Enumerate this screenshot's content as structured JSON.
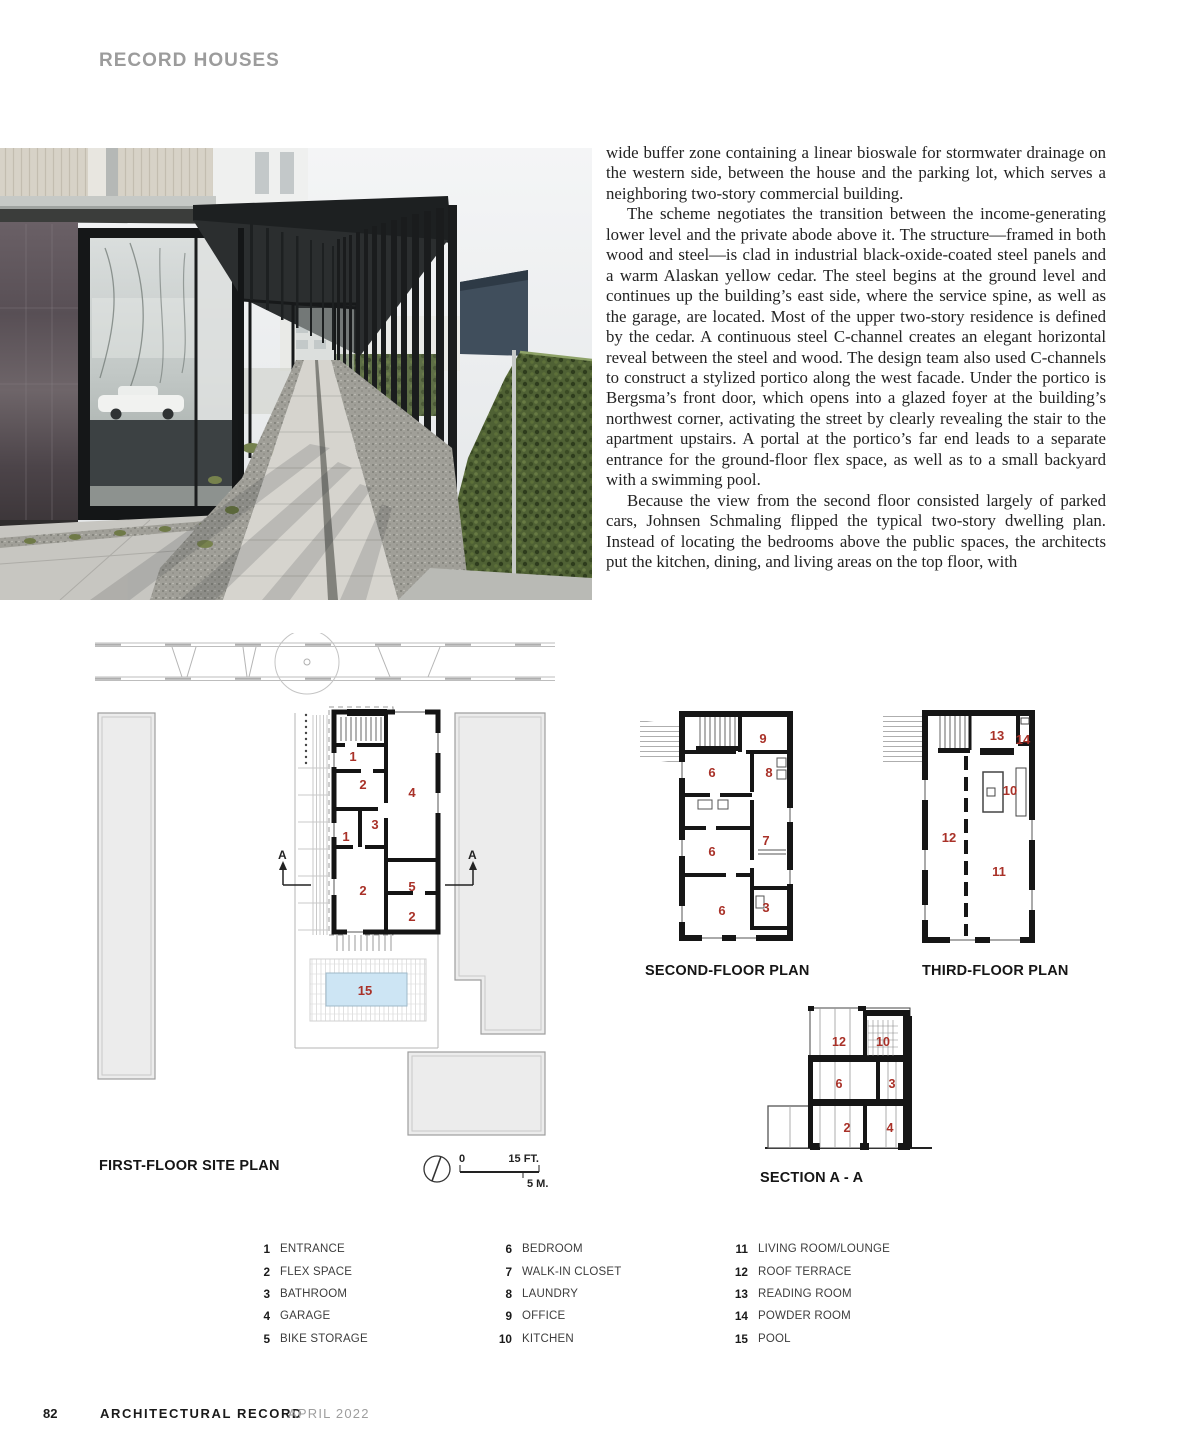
{
  "header": {
    "section_title": "RECORD HOUSES"
  },
  "article": {
    "paragraphs": [
      "wide buffer zone containing a linear bioswale for stormwater drainage on the western side, between the house and the parking lot, which serves a neighboring two-story commercial building.",
      "The scheme negotiates the transition between the income-generating lower level and the private abode above it. The structure—framed in both wood and steel—is clad in industrial black-oxide-coated steel panels and a warm Alaskan yellow cedar. The steel begins at the ground level and continues up the building’s east side, where the service spine, as well as the garage, are located. Most of the upper two-story residence is defined by the cedar. A continuous steel C-channel creates an elegant horizontal reveal between the steel and wood. The design team also used C-channels to construct a stylized portico along the west facade. Under the portico is Bergsma’s front door, which opens into a glazed foyer at the building’s northwest corner, activating the street by clearly revealing the stair to the apartment upstairs. A portal at the portico’s far end leads to a separate entrance for the ground-floor flex space, as well as to a small backyard with a swimming pool.",
      "Because the view from the second floor consisted largely of parked cars, Johnsen Schmaling flipped the typical two-story dwelling plan. Instead of locating the bedrooms above the public spaces, the architects put the kitchen, dining, and living areas on the top floor, with"
    ]
  },
  "plans": {
    "site": {
      "title": "FIRST-FLOOR SITE PLAN",
      "labels": [
        "1",
        "2",
        "4",
        "3",
        "1",
        "2",
        "5",
        "2",
        "15"
      ],
      "section_letter": "A"
    },
    "second": {
      "title": "SECOND-FLOOR PLAN",
      "labels": [
        "9",
        "6",
        "8",
        "6",
        "7",
        "6",
        "3"
      ]
    },
    "third": {
      "title": "THIRD-FLOOR PLAN",
      "labels": [
        "13",
        "14",
        "10",
        "12",
        "11"
      ]
    },
    "section": {
      "title": "SECTION A - A",
      "labels": [
        "12",
        "10",
        "6",
        "3",
        "2",
        "4"
      ]
    },
    "scale": {
      "zero": "0",
      "feet_label": "15 FT.",
      "meters_label": "5 M."
    }
  },
  "legend": {
    "columns": [
      [
        {
          "num": "1",
          "label": "ENTRANCE"
        },
        {
          "num": "2",
          "label": "FLEX SPACE"
        },
        {
          "num": "3",
          "label": "BATHROOM"
        },
        {
          "num": "4",
          "label": "GARAGE"
        },
        {
          "num": "5",
          "label": "BIKE STORAGE"
        }
      ],
      [
        {
          "num": "6",
          "label": "BEDROOM"
        },
        {
          "num": "7",
          "label": "WALK-IN CLOSET"
        },
        {
          "num": "8",
          "label": "LAUNDRY"
        },
        {
          "num": "9",
          "label": "OFFICE"
        },
        {
          "num": "10",
          "label": "KITCHEN"
        }
      ],
      [
        {
          "num": "11",
          "label": "LIVING ROOM/LOUNGE"
        },
        {
          "num": "12",
          "label": "ROOF TERRACE"
        },
        {
          "num": "13",
          "label": "READING ROOM"
        },
        {
          "num": "14",
          "label": "POWDER ROOM"
        },
        {
          "num": "15",
          "label": "POOL"
        }
      ]
    ]
  },
  "footer": {
    "page_number": "82",
    "magazine": "ARCHITECTURAL RECORD",
    "issue": "APRIL 2022"
  },
  "colors": {
    "accent_red": "#a93128",
    "pool_blue": "#cde5f4",
    "title_gray": "#9c9c9c"
  }
}
